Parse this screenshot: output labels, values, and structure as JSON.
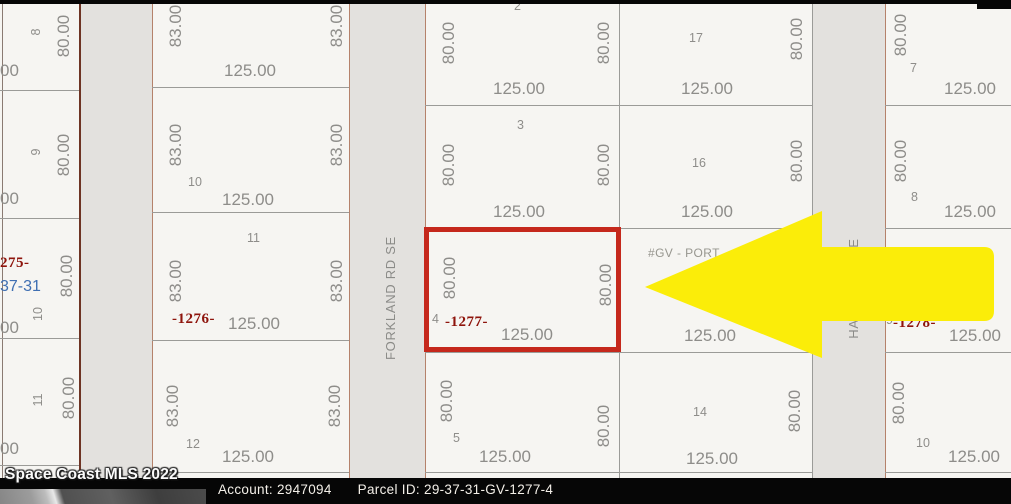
{
  "colors": {
    "map_bg": "#f6f5f2",
    "road_fill": "#e3e1de",
    "line_gray": "#9b9b98",
    "line_brown": "#b5826b",
    "line_dark_brown": "#6e3424",
    "dim_text": "#8e8d8a",
    "parcel_red": "#8e140c",
    "section_blue": "#3f6fb2",
    "highlight_red": "#c5281c",
    "arrow_yellow": "#fbed09",
    "bar_black": "#060606"
  },
  "map": {
    "roads": [
      {
        "x": 81,
        "w": 71
      },
      {
        "x": 350,
        "w": 75
      },
      {
        "x": 813,
        "w": 72
      }
    ],
    "vlines": [
      {
        "x": 2,
        "y": 4,
        "w": 1,
        "h": 474,
        "c": "#8a7a72"
      },
      {
        "x": 79,
        "y": 4,
        "w": 2,
        "h": 474,
        "c": "#6e3424"
      },
      {
        "x": 152,
        "y": 4,
        "w": 1,
        "h": 474,
        "c": "#b5826b"
      },
      {
        "x": 349,
        "y": 4,
        "w": 1,
        "h": 474,
        "c": "#b5826b"
      },
      {
        "x": 425,
        "y": 4,
        "w": 1,
        "h": 474,
        "c": "#b5826b"
      },
      {
        "x": 619,
        "y": 4,
        "w": 1,
        "h": 474,
        "c": "#9b9b98"
      },
      {
        "x": 812,
        "y": 4,
        "w": 1,
        "h": 474,
        "c": "#9b9b98"
      },
      {
        "x": 885,
        "y": 4,
        "w": 1,
        "h": 474,
        "c": "#b5826b"
      }
    ],
    "hlines": [
      {
        "x": 0,
        "w": 79,
        "y": 90
      },
      {
        "x": 0,
        "w": 79,
        "y": 218
      },
      {
        "x": 0,
        "w": 79,
        "y": 338
      },
      {
        "x": 0,
        "w": 79,
        "y": 465
      },
      {
        "x": 152,
        "w": 197,
        "y": 87
      },
      {
        "x": 152,
        "w": 197,
        "y": 212
      },
      {
        "x": 152,
        "w": 197,
        "y": 340
      },
      {
        "x": 152,
        "w": 197,
        "y": 472
      },
      {
        "x": 425,
        "w": 194,
        "y": 105
      },
      {
        "x": 425,
        "w": 194,
        "y": 228
      },
      {
        "x": 425,
        "w": 194,
        "y": 352
      },
      {
        "x": 425,
        "w": 194,
        "y": 472
      },
      {
        "x": 619,
        "w": 193,
        "y": 105
      },
      {
        "x": 619,
        "w": 193,
        "y": 228
      },
      {
        "x": 619,
        "w": 193,
        "y": 352
      },
      {
        "x": 619,
        "w": 193,
        "y": 472
      },
      {
        "x": 885,
        "w": 126,
        "y": 105
      },
      {
        "x": 885,
        "w": 126,
        "y": 228
      },
      {
        "x": 885,
        "w": 126,
        "y": 352
      },
      {
        "x": 885,
        "w": 126,
        "y": 472
      }
    ],
    "labels": [
      {
        "t": "8",
        "x": 30,
        "y": 40,
        "len": 16,
        "c": "numv"
      },
      {
        "t": "80.00",
        "x": 55,
        "y": 63,
        "len": 54,
        "c": "dimv"
      },
      {
        "t": "00",
        "x": 0,
        "y": 62,
        "c": "dim"
      },
      {
        "t": "9",
        "x": 30,
        "y": 160,
        "len": 16,
        "c": "numv"
      },
      {
        "t": "80.00",
        "x": 55,
        "y": 182,
        "len": 54,
        "c": "dimv"
      },
      {
        "t": "00",
        "x": 0,
        "y": 190,
        "c": "dim"
      },
      {
        "t": "275-",
        "x": 0,
        "y": 256,
        "c": "red"
      },
      {
        "t": "37-31",
        "x": 0,
        "y": 279,
        "c": "blue"
      },
      {
        "t": "80.00",
        "x": 58,
        "y": 303,
        "len": 54,
        "c": "dimv"
      },
      {
        "t": "10",
        "x": 32,
        "y": 322,
        "len": 16,
        "c": "numv"
      },
      {
        "t": "00",
        "x": 0,
        "y": 319,
        "c": "dim"
      },
      {
        "t": "11",
        "x": 32,
        "y": 408,
        "len": 16,
        "c": "numv"
      },
      {
        "t": "80.00",
        "x": 60,
        "y": 425,
        "len": 54,
        "c": "dimv"
      },
      {
        "t": "00",
        "x": 0,
        "y": 440,
        "c": "dim"
      },
      {
        "t": "83.00",
        "x": 167,
        "y": 53,
        "len": 54,
        "c": "dimv"
      },
      {
        "t": "83.00",
        "x": 328,
        "y": 53,
        "len": 54,
        "c": "dimv"
      },
      {
        "t": "125.00",
        "x": 224,
        "y": 62,
        "c": "dim"
      },
      {
        "t": "83.00",
        "x": 167,
        "y": 172,
        "len": 54,
        "c": "dimv"
      },
      {
        "t": "83.00",
        "x": 328,
        "y": 172,
        "len": 54,
        "c": "dimv"
      },
      {
        "t": "10",
        "x": 188,
        "y": 176,
        "c": "num"
      },
      {
        "t": "125.00",
        "x": 222,
        "y": 191,
        "c": "dim"
      },
      {
        "t": "11",
        "x": 247,
        "y": 232,
        "c": "num"
      },
      {
        "t": "83.00",
        "x": 167,
        "y": 308,
        "len": 54,
        "c": "dimv"
      },
      {
        "t": "83.00",
        "x": 328,
        "y": 308,
        "len": 54,
        "c": "dimv"
      },
      {
        "t": "-1276-",
        "x": 172,
        "y": 312,
        "c": "red"
      },
      {
        "t": "125.00",
        "x": 228,
        "y": 315,
        "c": "dim"
      },
      {
        "t": "83.00",
        "x": 164,
        "y": 433,
        "len": 54,
        "c": "dimv"
      },
      {
        "t": "83.00",
        "x": 326,
        "y": 433,
        "len": 54,
        "c": "dimv"
      },
      {
        "t": "12",
        "x": 186,
        "y": 438,
        "c": "num"
      },
      {
        "t": "125.00",
        "x": 222,
        "y": 448,
        "c": "dim"
      },
      {
        "t": "FORKLAND RD SE",
        "x": 384,
        "y": 360,
        "len": 110,
        "c": "roadlbl"
      },
      {
        "t": "2",
        "x": 514,
        "y": 0,
        "c": "num"
      },
      {
        "t": "80.00",
        "x": 440,
        "y": 70,
        "len": 54,
        "c": "dimv"
      },
      {
        "t": "80.00",
        "x": 595,
        "y": 70,
        "len": 54,
        "c": "dimv"
      },
      {
        "t": "125.00",
        "x": 493,
        "y": 80,
        "c": "dim"
      },
      {
        "t": "3",
        "x": 517,
        "y": 119,
        "c": "num"
      },
      {
        "t": "80.00",
        "x": 440,
        "y": 192,
        "len": 54,
        "c": "dimv"
      },
      {
        "t": "80.00",
        "x": 595,
        "y": 192,
        "len": 54,
        "c": "dimv"
      },
      {
        "t": "125.00",
        "x": 493,
        "y": 203,
        "c": "dim"
      },
      {
        "t": "80.00",
        "x": 441,
        "y": 305,
        "len": 54,
        "c": "dimv"
      },
      {
        "t": "80.00",
        "x": 597,
        "y": 312,
        "len": 54,
        "c": "dimv"
      },
      {
        "t": "4",
        "x": 432,
        "y": 313,
        "c": "num"
      },
      {
        "t": "-1277-",
        "x": 445,
        "y": 315,
        "c": "red"
      },
      {
        "t": "125.00",
        "x": 501,
        "y": 326,
        "c": "dim"
      },
      {
        "t": "80.00",
        "x": 438,
        "y": 428,
        "len": 54,
        "c": "dimv"
      },
      {
        "t": "5",
        "x": 453,
        "y": 432,
        "c": "num"
      },
      {
        "t": "125.00",
        "x": 479,
        "y": 448,
        "c": "dim"
      },
      {
        "t": "80.00",
        "x": 595,
        "y": 453,
        "len": 54,
        "c": "dimv"
      },
      {
        "t": "17",
        "x": 689,
        "y": 32,
        "c": "num"
      },
      {
        "t": "80.00",
        "x": 788,
        "y": 66,
        "len": 54,
        "c": "dimv"
      },
      {
        "t": "125.00",
        "x": 681,
        "y": 80,
        "c": "dim"
      },
      {
        "t": "16",
        "x": 692,
        "y": 157,
        "c": "num"
      },
      {
        "t": "80.00",
        "x": 788,
        "y": 188,
        "len": 54,
        "c": "dimv"
      },
      {
        "t": "125.00",
        "x": 681,
        "y": 203,
        "c": "dim"
      },
      {
        "t": "#GV - PORT",
        "x": 648,
        "y": 247,
        "c": "note"
      },
      {
        "t": "125.00",
        "x": 684,
        "y": 327,
        "c": "dim"
      },
      {
        "t": "14",
        "x": 693,
        "y": 406,
        "c": "num"
      },
      {
        "t": "80.00",
        "x": 786,
        "y": 438,
        "len": 54,
        "c": "dimv"
      },
      {
        "t": "125.00",
        "x": 686,
        "y": 450,
        "c": "dim"
      },
      {
        "t": "E",
        "x": 847,
        "y": 249,
        "len": 12,
        "c": "roadlbl"
      },
      {
        "t": "HA",
        "x": 847,
        "y": 341,
        "len": 24,
        "c": "roadlbl"
      },
      {
        "t": "80.00",
        "x": 892,
        "y": 62,
        "len": 54,
        "c": "dimv"
      },
      {
        "t": "7",
        "x": 910,
        "y": 62,
        "c": "num"
      },
      {
        "t": "125.00",
        "x": 944,
        "y": 80,
        "c": "dim"
      },
      {
        "t": "80.00",
        "x": 892,
        "y": 188,
        "len": 54,
        "c": "dimv"
      },
      {
        "t": "8",
        "x": 911,
        "y": 191,
        "c": "num"
      },
      {
        "t": "125.00",
        "x": 944,
        "y": 203,
        "c": "dim"
      },
      {
        "t": "9",
        "x": 886,
        "y": 314,
        "c": "num"
      },
      {
        "t": "-1278-",
        "x": 893,
        "y": 316,
        "c": "red"
      },
      {
        "t": "125.00",
        "x": 949,
        "y": 327,
        "c": "dim"
      },
      {
        "t": "80.00",
        "x": 890,
        "y": 430,
        "len": 54,
        "c": "dimv"
      },
      {
        "t": "10",
        "x": 916,
        "y": 437,
        "c": "num"
      },
      {
        "t": "125.00",
        "x": 948,
        "y": 448,
        "c": "dim"
      }
    ],
    "highlight_box": {
      "x": 424,
      "y": 227,
      "w": 197,
      "h": 125
    },
    "arrow_path": "M645,287 L822,211 L822,247 L984,247 Q994,247 994,257 L994,311 Q994,321 984,321 L822,321 L822,358 Z",
    "top_bars": [
      {
        "x": 0,
        "y": 0,
        "w": 1011,
        "h": 4
      },
      {
        "x": 977,
        "y": 0,
        "w": 34,
        "h": 9
      }
    ]
  },
  "footer": {
    "watermark": "Space Coast MLS 2022",
    "account_label": "Account:",
    "account_value": "2947094",
    "parcel_label": "Parcel ID:",
    "parcel_value": "29-37-31-GV-1277-4"
  }
}
